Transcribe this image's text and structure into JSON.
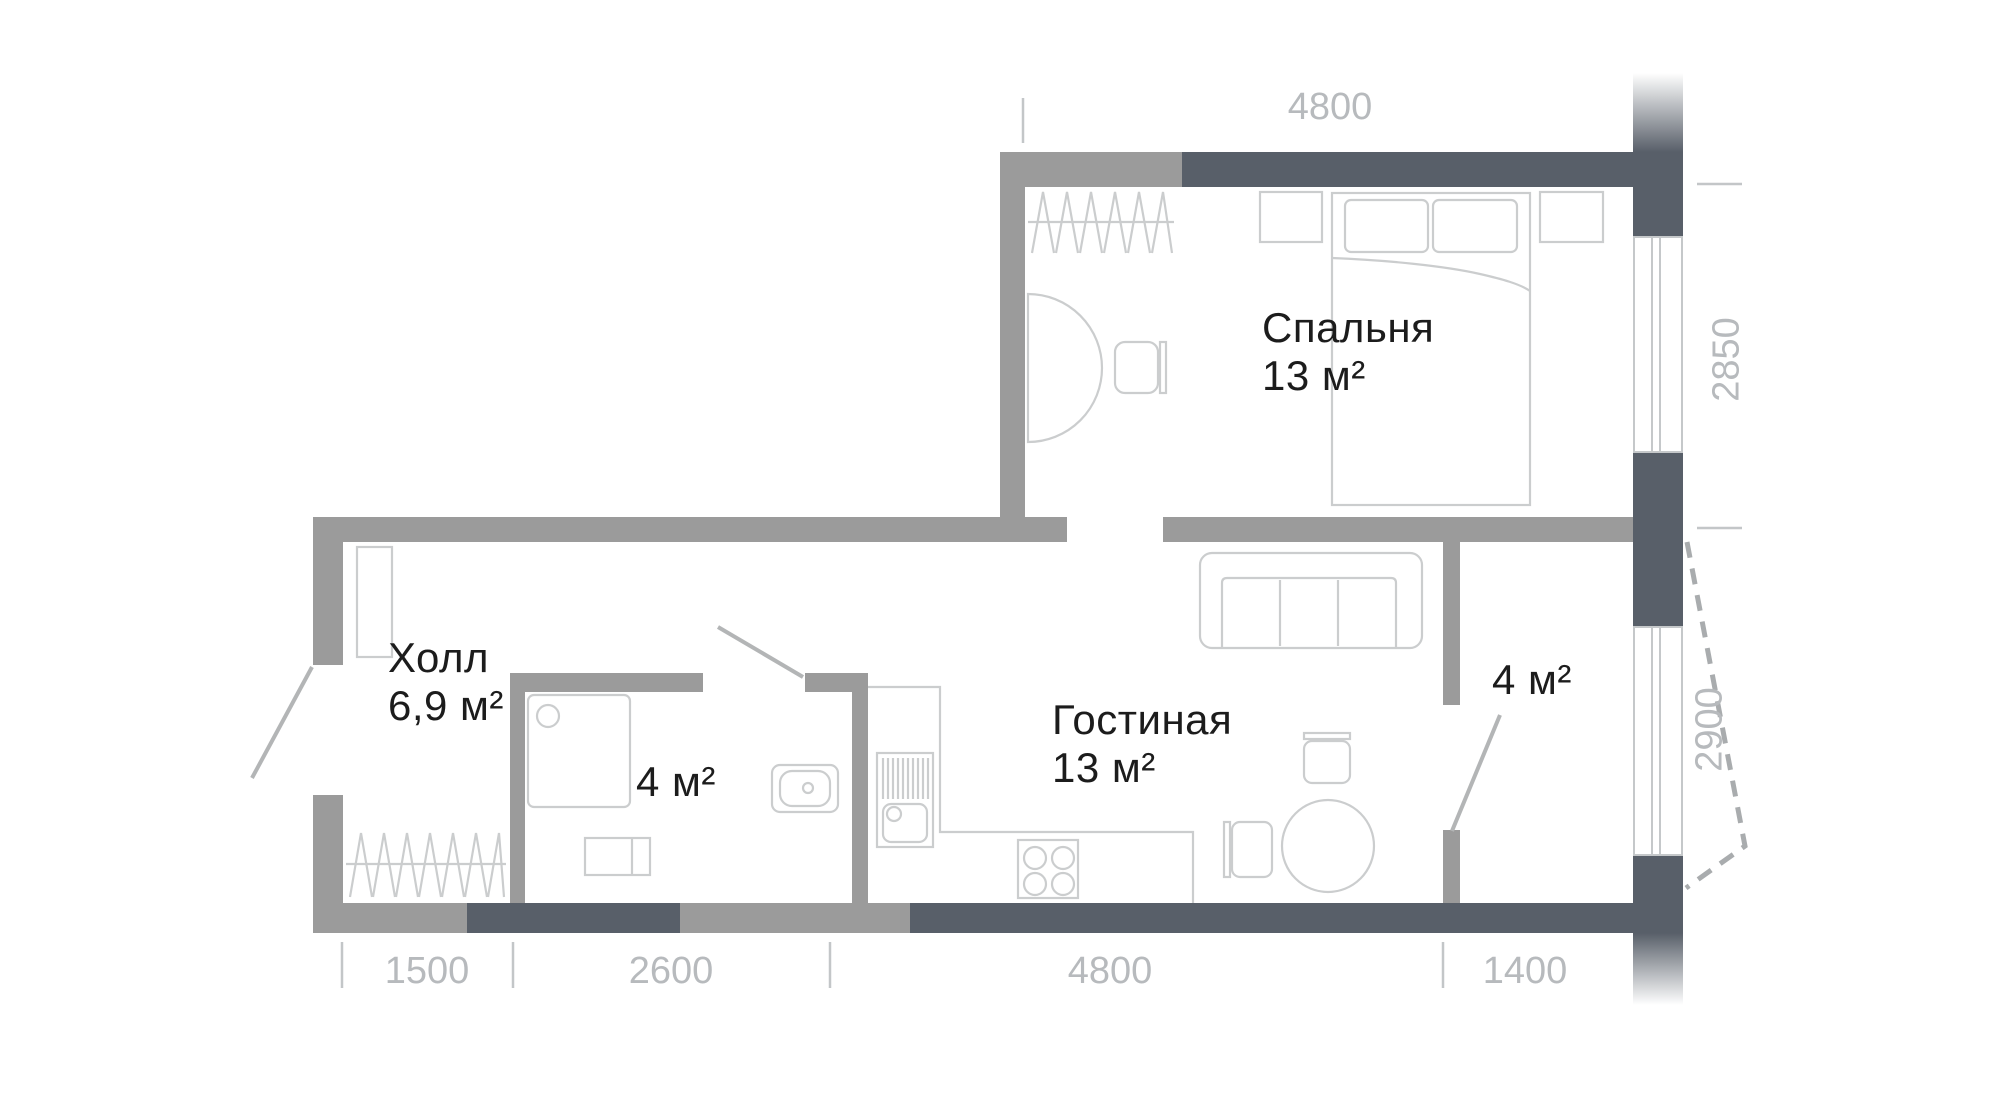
{
  "plan_title": "Apartment floor plan",
  "rooms": {
    "bedroom": {
      "name": "Спальня",
      "area": "13 м²"
    },
    "living": {
      "name": "Гостиная",
      "area": "13 м²"
    },
    "hall": {
      "name": "Холл",
      "area": "6,9 м²"
    },
    "bathroom": {
      "area": "4 м²"
    },
    "small_room": {
      "area": "4 м²"
    }
  },
  "dims": {
    "top": "4800",
    "right_upper": "2850",
    "right_lower": "2900",
    "bottom_1": "1500",
    "bottom_2": "2600",
    "bottom_3": "4800",
    "bottom_4": "1400"
  },
  "colors": {
    "wall_light": "#9b9b9b",
    "wall_dark": "#585f69",
    "furniture_line": "#cbcdce",
    "door_line": "#b3b5b6",
    "dash_line": "#a9acae",
    "tick_line": "#c3c6c8",
    "window_line": "#c5c8ca",
    "label_text": "#1c1c1c",
    "dimension_text": "#b7babd"
  },
  "furniture": [
    "wardrobe-hangers-bedroom",
    "nightstand-left",
    "double-bed",
    "nightstand-right",
    "dressing-table",
    "bedroom-chair",
    "hall-cabinet",
    "wardrobe-hangers-hall",
    "shower-cabin",
    "washing-machine",
    "bathroom-sink",
    "kitchen-counter",
    "kitchen-sink-unit",
    "stove",
    "sofa",
    "dining-table",
    "dining-chair-top",
    "dining-chair-left"
  ]
}
